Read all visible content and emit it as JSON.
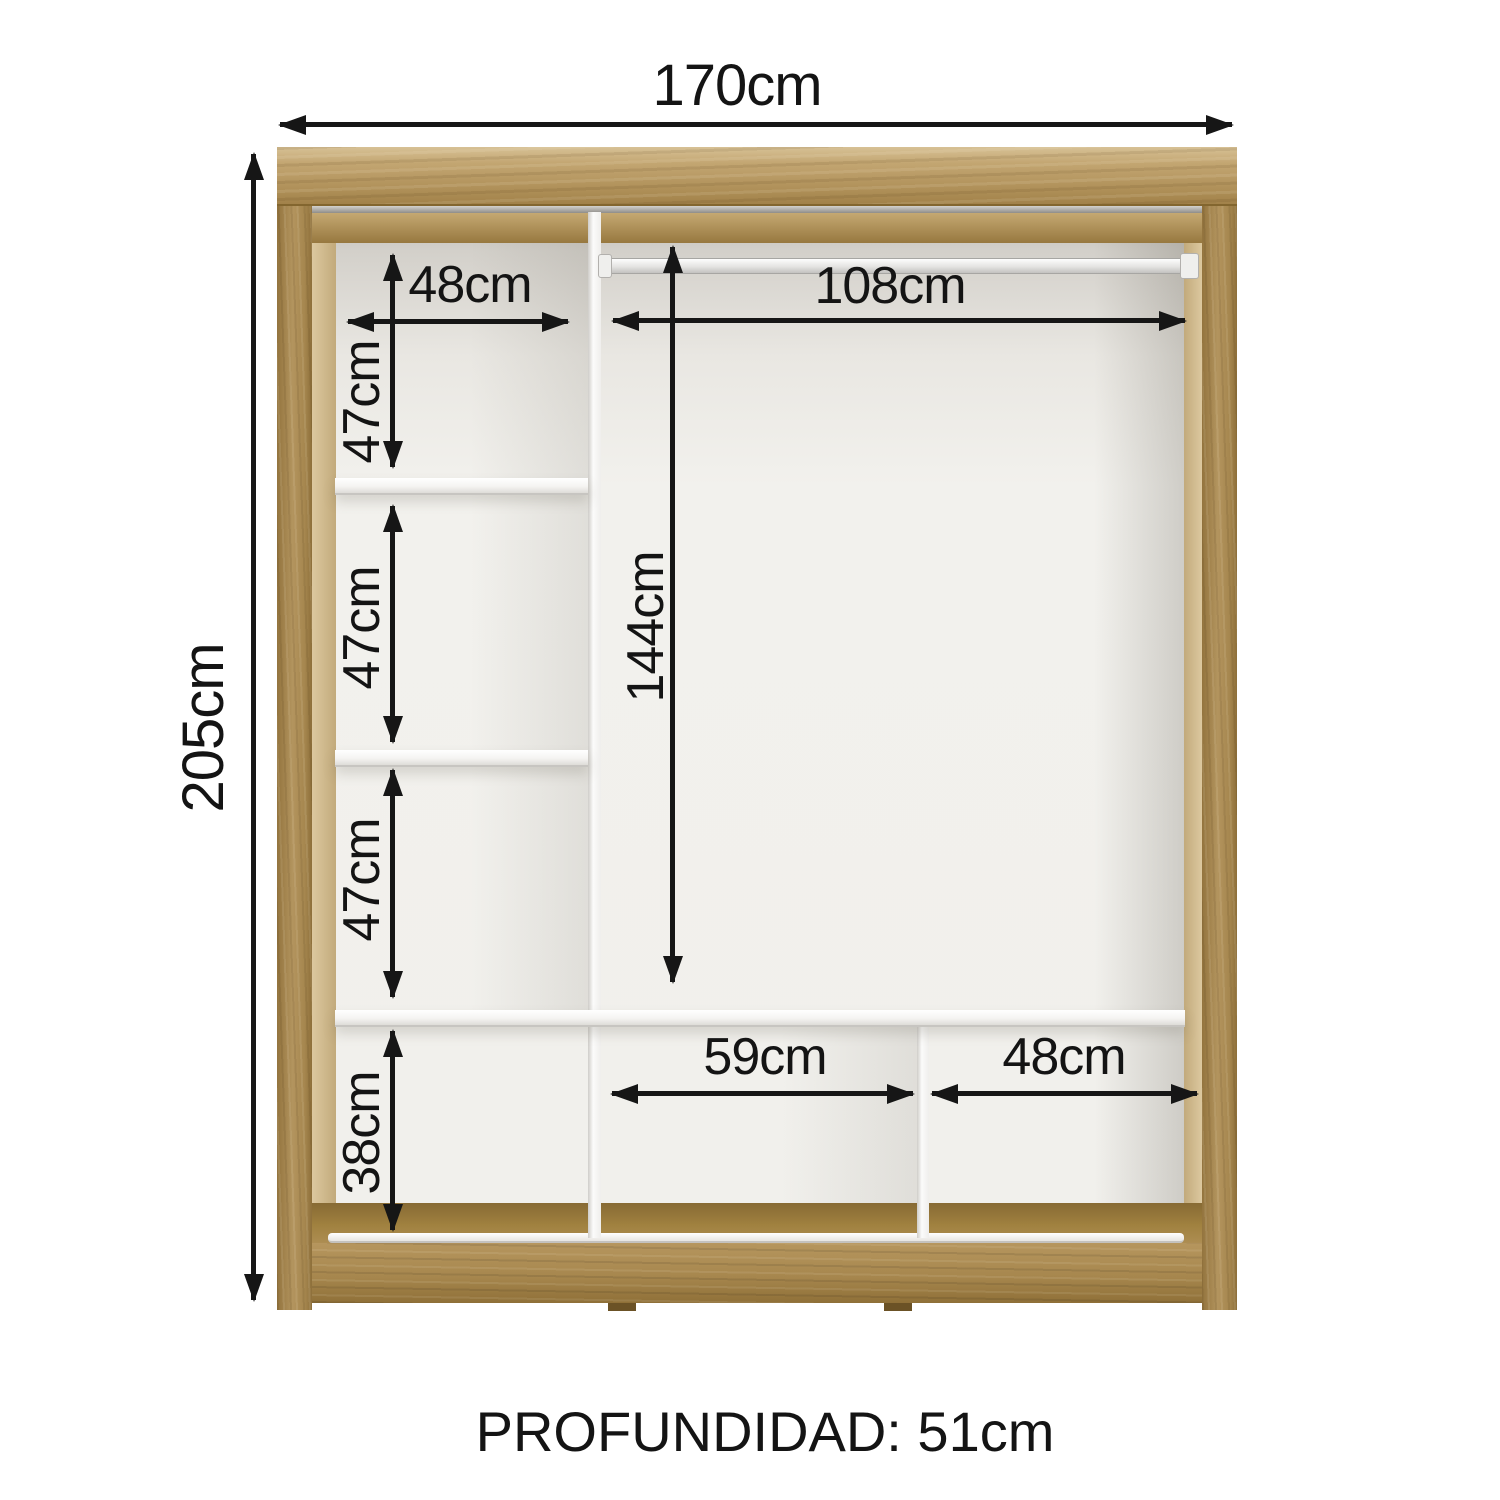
{
  "diagram_title": "wardrobe interior dimensions",
  "dimensions": {
    "overall_width": "170cm",
    "overall_height": "205cm",
    "left_shelf_width": "48cm",
    "left_compartment_1": "47cm",
    "left_compartment_2": "47cm",
    "left_compartment_3": "47cm",
    "left_compartment_4": "38cm",
    "rod_width": "108cm",
    "hanging_height": "144cm",
    "bottom_middle_width": "59cm",
    "bottom_right_width": "48cm",
    "depth": "PROFUNDIDAD: 51cm"
  },
  "colors": {
    "wood": "#b3945e",
    "wood_dark": "#8d6f3a",
    "wood_light": "#d7c195",
    "interior_back": "#f1f0ec",
    "panel_white": "#fbfbfa",
    "dimension_text": "#141414",
    "arrow": "#161616",
    "background": "#ffffff"
  }
}
